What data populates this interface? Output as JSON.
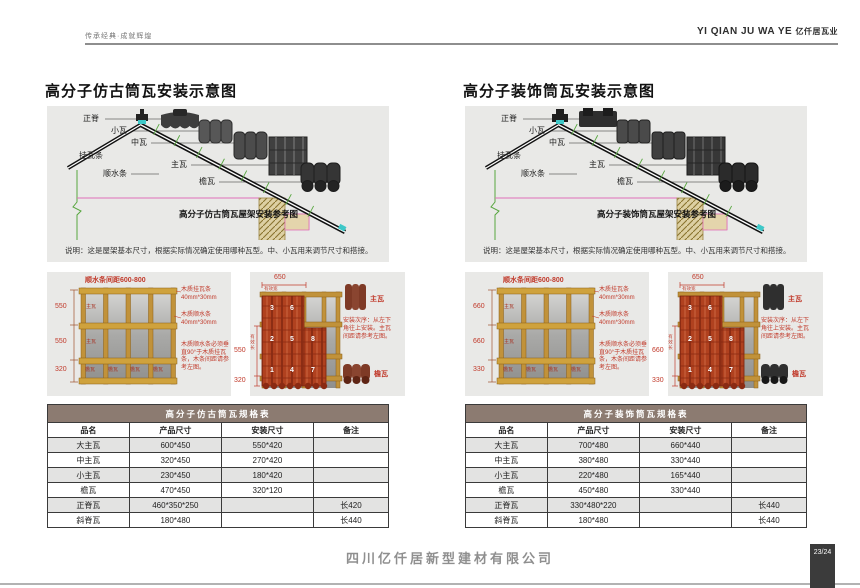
{
  "header": {
    "slogan": "传承经典·成就辉煌",
    "brand_en": "YI QIAN JU WA YE",
    "brand_cn": "亿仟居瓦业"
  },
  "columns": [
    {
      "title": "高分子仿古筒瓦安装示意图",
      "roof": {
        "ridge": "正脊",
        "small_tile": "小瓦",
        "mid_tile": "中瓦",
        "main_tile": "主瓦",
        "hang_batten": "挂瓦条",
        "water_batten": "顺水条",
        "eave_tile": "檐瓦",
        "caption": "高分子仿古筒瓦屋架安装参考图",
        "note": "说明：这是屋架基本尺寸，根据实际情况确定使用哪种瓦型。中、小瓦用来调节尺寸和搭接。"
      },
      "grid_panel": {
        "title": "顺水条间距600-800",
        "dims": [
          "550",
          "550",
          "320"
        ],
        "main_cell": "主瓦",
        "eave_cell": "檐瓦",
        "ann1": "木质挂瓦条",
        "ann1_size": "40mm*30mm",
        "ann2": "木质顺水条",
        "ann2_size": "40mm*30mm",
        "ann3": "木质顺水条必须垂直90°于木质挂瓦条，木条间距请参考左图。"
      },
      "lay_panel": {
        "width_dim": "650",
        "eff_width": "有效宽",
        "height_dim": "550",
        "eff_length": "有效长",
        "eave_dim": "320",
        "numbers": [
          "3",
          "6",
          "2",
          "5",
          "8",
          "1",
          "4",
          "7"
        ],
        "main_label": "主瓦",
        "eave_label": "檐瓦",
        "order_note": "安装次序：从左下角往上安装。主瓦间距请参考左图。"
      },
      "table": {
        "title": "高分子仿古筒瓦规格表",
        "headers": [
          "品名",
          "产品尺寸",
          "安装尺寸",
          "备注"
        ],
        "rows": [
          [
            "大主瓦",
            "600*450",
            "550*420",
            ""
          ],
          [
            "中主瓦",
            "320*450",
            "270*420",
            ""
          ],
          [
            "小主瓦",
            "230*450",
            "180*420",
            ""
          ],
          [
            "檐瓦",
            "470*450",
            "320*120",
            ""
          ],
          [
            "正脊瓦",
            "460*350*250",
            "",
            "长420"
          ],
          [
            "斜脊瓦",
            "180*480",
            "",
            "长440"
          ]
        ]
      }
    },
    {
      "title": "高分子装饰筒瓦安装示意图",
      "roof": {
        "ridge": "正脊",
        "small_tile": "小瓦",
        "mid_tile": "中瓦",
        "main_tile": "主瓦",
        "hang_batten": "挂瓦条",
        "water_batten": "顺水条",
        "eave_tile": "檐瓦",
        "caption": "高分子装饰筒瓦屋架安装参考图",
        "note": "说明：这是屋架基本尺寸，根据实际情况确定使用哪种瓦型。中、小瓦用来调节尺寸和搭接。"
      },
      "grid_panel": {
        "title": "顺水条间距600-800",
        "dims": [
          "660",
          "660",
          "330"
        ],
        "main_cell": "主瓦",
        "eave_cell": "檐瓦",
        "ann1": "木质挂瓦条",
        "ann1_size": "40mm*30mm",
        "ann2": "木质顺水条",
        "ann2_size": "40mm*30mm",
        "ann3": "木质顺水条必须垂直90°于木质挂瓦条，木条间距请参考左图。"
      },
      "lay_panel": {
        "width_dim": "650",
        "eff_width": "有效宽",
        "height_dim": "660",
        "eff_length": "有效长",
        "eave_dim": "330",
        "numbers": [
          "3",
          "6",
          "2",
          "5",
          "8",
          "1",
          "4",
          "7"
        ],
        "main_label": "主瓦",
        "eave_label": "檐瓦",
        "order_note": "安装次序：从左下角往上安装。主瓦间距请参考左图。"
      },
      "table": {
        "title": "高分子装饰筒瓦规格表",
        "headers": [
          "品名",
          "产品尺寸",
          "安装尺寸",
          "备注"
        ],
        "rows": [
          [
            "大主瓦",
            "700*480",
            "660*440",
            ""
          ],
          [
            "中主瓦",
            "380*480",
            "330*440",
            ""
          ],
          [
            "小主瓦",
            "220*480",
            "165*440",
            ""
          ],
          [
            "檐瓦",
            "450*480",
            "330*440",
            ""
          ],
          [
            "正脊瓦",
            "330*480*220",
            "",
            "长440"
          ],
          [
            "斜脊瓦",
            "180*480",
            "",
            "长440"
          ]
        ]
      }
    }
  ],
  "footer": {
    "company": "四川亿仟居新型建材有限公司",
    "page": "23/24"
  },
  "colors": {
    "accent_red": "#c13a2b",
    "batten_gold": "#c1923a",
    "tile_red": "#b0411f",
    "table_title_bg": "#8c7b71",
    "panel_bg": "#e9e9e7",
    "construction_green": "#57a63f",
    "construction_pink": "#e06fb8"
  }
}
